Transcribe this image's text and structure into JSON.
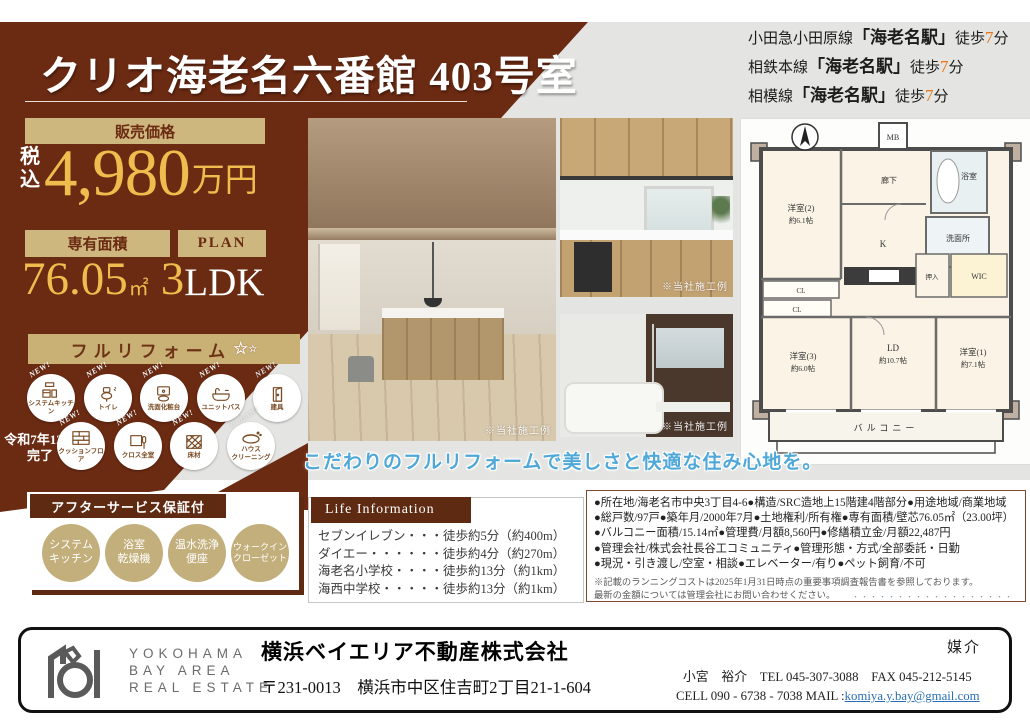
{
  "colors": {
    "brown": "#6b2a12",
    "tan": "#c9b176",
    "gold": "#eebd4e",
    "accent_orange": "#e87413",
    "catch_blue": "#4fa8d8"
  },
  "header": {
    "title": "クリオ海老名六番館 403号室"
  },
  "access": {
    "lines": [
      {
        "route": "小田急小田原線",
        "station": "「海老名駅」",
        "walk": "徒歩",
        "minutes": "7",
        "unit": "分"
      },
      {
        "route": "相鉄本線",
        "station": "「海老名駅」",
        "walk": "徒歩",
        "minutes": "7",
        "unit": "分"
      },
      {
        "route": "相模線",
        "station": "「海老名駅」",
        "walk": "徒歩",
        "minutes": "7",
        "unit": "分"
      }
    ]
  },
  "price_panel": {
    "label": "販売価格",
    "tax": "税\n込",
    "amount": "4,980",
    "unit": "万円",
    "area_label": "専有面積",
    "area": "76.05",
    "area_unit": "㎡",
    "plan_label": "PLAN",
    "plan_num": "3",
    "plan_type": "LDK"
  },
  "reform": {
    "banner": "フルリフォーム",
    "sparkle_large": "☆",
    "sparkle_small": "☆",
    "completion": "令和7年12月\n完了",
    "items": [
      {
        "badge": "NEW!",
        "label": "システムキッチン"
      },
      {
        "badge": "NEW!",
        "label": "トイレ"
      },
      {
        "badge": "NEW!",
        "label": "洗面化粧台"
      },
      {
        "badge": "NEW!",
        "label": "ユニットバス"
      },
      {
        "badge": "NEW!",
        "label": "建具"
      },
      {
        "badge": "NEW!",
        "label": "クッションフロア"
      },
      {
        "badge": "NEW!",
        "label": "クロス全室"
      },
      {
        "badge": "NEW!",
        "label": "床材"
      },
      {
        "badge": "CLEAN!",
        "label": "ハウス\nクリーニング"
      }
    ]
  },
  "after_service": {
    "label": "アフターサービス保証付",
    "items": [
      "システム\nキッチン",
      "浴室\n乾燥機",
      "温水洗浄\n便座",
      "ウォークイン\nクローゼット"
    ]
  },
  "photos": {
    "note": "※当社施工例"
  },
  "tagline": "こだわりのフルリフォームで美しさと快適な住み心地を。",
  "life_info": {
    "header": "Life Information",
    "items": [
      "セブンイレブン・・・徒歩約5分（約400m）",
      "ダイエー・・・・・・徒歩約4分（約270m）",
      "海老名小学校・・・・徒歩約13分（約1km）",
      "海西中学校・・・・・徒歩約13分（約1km）"
    ]
  },
  "details": {
    "lines": [
      "●所在地/海老名市中央3丁目4-6●構造/SRC造地上15階建4階部分●用途地域/商業地域",
      "●総戸数/97戸●築年月/2000年7月●土地権利/所有権●専有面積/壁芯76.05㎡（23.00坪）",
      "●バルコニー面積/15.14㎡●管理費/月額8,560円●修繕積立金/月額22,487円",
      "●管理会社/株式会社長谷工コミュニティ●管理形態・方式/全部委託・日勤",
      "●現況・引き渡し/空室・相談●エレベーター/有り●ペット飼育/不可"
    ],
    "notes": [
      "※記載のランニングコストは2025年1月31日時点の重要事項調査報告書を参照しております。",
      "最新の金額については管理会社にお問い合わせください。"
    ]
  },
  "fine_print": "・・・・・・・・・・・・・・・・・・",
  "floorplan": {
    "mb": "MB",
    "hallway": "廊下",
    "bath": "浴室",
    "washroom": "洗面所",
    "kitchen": "K",
    "wic": "WIC",
    "oshiire1": "押入",
    "cl1": "CL",
    "cl2": "CL",
    "room2_name": "洋室(2)",
    "room2_size": "約6.1帖",
    "room3_name": "洋室(3)",
    "room3_size": "約6.0帖",
    "room1_name": "洋室(1)",
    "room1_size": "約7.1帖",
    "ld_name": "LD",
    "ld_size": "約10.7帖",
    "balcony": "バルコニー"
  },
  "footer": {
    "logo_lines": [
      "YOKOHAMA",
      "BAY AREA",
      "REAL ESTATE"
    ],
    "company": "横浜ベイエリア不動産株式会社",
    "address": "〒231-0013　横浜市中区住吉町2丁目21-1-604",
    "agency": "媒介",
    "agent": "小宮　裕介",
    "tel": "TEL 045-307-3088",
    "fax": "FAX 045-212-5145",
    "cell": "CELL 090 - 6738 - 7038",
    "mail_label": "MAIL :",
    "email": "komiya.y.bay@gmail.com"
  }
}
